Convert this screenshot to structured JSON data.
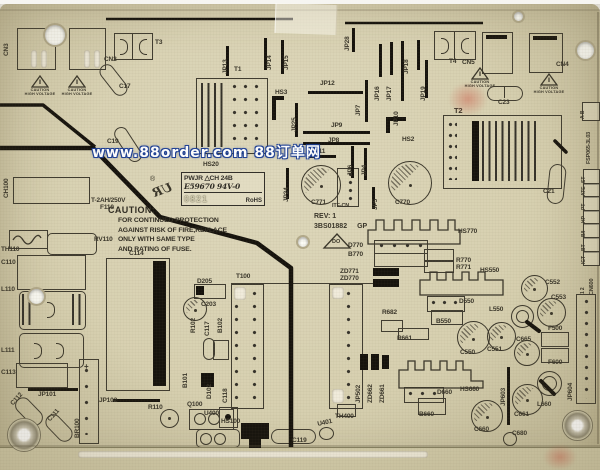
{
  "watermark": {
    "text": "www.88order.com 88订单网",
    "fill": "#ffffff",
    "outline": "#1d3e94"
  },
  "board": {
    "model": "FSP065-3L03",
    "base_color": "#d7d0b0",
    "silk_color": "#3a362a",
    "trace_color": "#16130d"
  },
  "ul_label": {
    "reg": "®",
    "ur": "UR",
    "line1": "PWJR  △CH 24B",
    "line2": "E59670  94V-0",
    "date": "0821",
    "rohs": "RoHS"
  },
  "caution": {
    "heading": "CAUTION:",
    "lines": [
      "FOR CONTINUED PROTECTION",
      "AGAINST RISK OF FIRE,REPLACE",
      "ONLY WITH SAME TYPE",
      "AND RATING OF FUSE."
    ]
  },
  "revision": {
    "rev": "REV: 1",
    "code": "3BS01882",
    "suffix": "GP",
    "triangle_mark": "DO"
  },
  "warning": {
    "line1": "CAUTION",
    "line2": "HIGH VOLTAGE"
  },
  "edge_strip": {
    "ab": "A B",
    "model": "FSP065-3L03",
    "tags": [
      "ST",
      "ATE",
      "PT",
      "HP",
      "B/I",
      "BT",
      "ICT"
    ],
    "connector": "CN600",
    "pins": "1 2"
  },
  "silkscreen_labels": [
    {
      "t": "CN2",
      "x": 104,
      "y": 53
    },
    {
      "t": "T3",
      "x": 155,
      "y": 36
    },
    {
      "t": "C17",
      "x": 119,
      "y": 80
    },
    {
      "t": "T1",
      "x": 234,
      "y": 63
    },
    {
      "t": "T4",
      "x": 449,
      "y": 55
    },
    {
      "t": "CN5",
      "x": 462,
      "y": 56
    },
    {
      "t": "CN4",
      "x": 556,
      "y": 58
    },
    {
      "t": "C23",
      "x": 498,
      "y": 96
    },
    {
      "t": "T2",
      "x": 454,
      "y": 103,
      "s": 7.5
    },
    {
      "t": "C21",
      "x": 543,
      "y": 185
    },
    {
      "t": "HS3",
      "x": 275,
      "y": 86
    },
    {
      "t": "JP12",
      "x": 320,
      "y": 77
    },
    {
      "t": "JP9",
      "x": 331,
      "y": 119
    },
    {
      "t": "JP8",
      "x": 328,
      "y": 134
    },
    {
      "t": "JP11",
      "x": 311,
      "y": 145
    },
    {
      "t": "HS2",
      "x": 402,
      "y": 133
    },
    {
      "t": "HS20",
      "x": 203,
      "y": 158
    },
    {
      "t": "C771",
      "x": 311,
      "y": 196
    },
    {
      "t": "ITF-CN",
      "x": 332,
      "y": 200,
      "s": 5.5
    },
    {
      "t": "C770",
      "x": 395,
      "y": 196
    },
    {
      "t": "C19",
      "x": 107,
      "y": 135
    },
    {
      "t": "T-2AH/250V",
      "x": 91,
      "y": 194
    },
    {
      "t": "F110",
      "x": 100,
      "y": 201
    },
    {
      "t": "RV110",
      "x": 94,
      "y": 233
    },
    {
      "t": "TH110",
      "x": 1,
      "y": 243
    },
    {
      "t": "C110",
      "x": 1,
      "y": 256
    },
    {
      "t": "L110",
      "x": 1,
      "y": 283
    },
    {
      "t": "L111",
      "x": 1,
      "y": 344
    },
    {
      "t": "C114",
      "x": 129,
      "y": 247
    },
    {
      "t": "C113",
      "x": 1,
      "y": 366
    },
    {
      "t": "JP101",
      "x": 38,
      "y": 388
    },
    {
      "t": "JP102",
      "x": 99,
      "y": 394
    },
    {
      "t": "R110",
      "x": 148,
      "y": 401
    },
    {
      "t": "Q100",
      "x": 187,
      "y": 398
    },
    {
      "t": "D205",
      "x": 197,
      "y": 275
    },
    {
      "t": "C203",
      "x": 201,
      "y": 298
    },
    {
      "t": "T100",
      "x": 236,
      "y": 270
    },
    {
      "t": "HS100",
      "x": 221,
      "y": 415
    },
    {
      "t": "U400",
      "x": 204,
      "y": 407
    },
    {
      "t": "C119",
      "x": 292,
      "y": 434
    },
    {
      "t": "TH400",
      "x": 335,
      "y": 410
    },
    {
      "t": "ZD771",
      "x": 340,
      "y": 265
    },
    {
      "t": "ZD770",
      "x": 340,
      "y": 272
    },
    {
      "t": "D770",
      "x": 348,
      "y": 239
    },
    {
      "t": "B770",
      "x": 348,
      "y": 248
    },
    {
      "t": "R770",
      "x": 456,
      "y": 254
    },
    {
      "t": "R771",
      "x": 456,
      "y": 261
    },
    {
      "t": "HS770",
      "x": 458,
      "y": 225
    },
    {
      "t": "R682",
      "x": 382,
      "y": 306
    },
    {
      "t": "R661",
      "x": 397,
      "y": 332
    },
    {
      "t": "HS550",
      "x": 480,
      "y": 264
    },
    {
      "t": "D550",
      "x": 459,
      "y": 295
    },
    {
      "t": "B550",
      "x": 436,
      "y": 315
    },
    {
      "t": "C550",
      "x": 460,
      "y": 346
    },
    {
      "t": "C551",
      "x": 487,
      "y": 343
    },
    {
      "t": "L550",
      "x": 489,
      "y": 303
    },
    {
      "t": "C552",
      "x": 545,
      "y": 276
    },
    {
      "t": "C553",
      "x": 551,
      "y": 291
    },
    {
      "t": "C665",
      "x": 516,
      "y": 333
    },
    {
      "t": "F500",
      "x": 548,
      "y": 322
    },
    {
      "t": "F600",
      "x": 548,
      "y": 356
    },
    {
      "t": "HS660",
      "x": 460,
      "y": 383
    },
    {
      "t": "D660",
      "x": 437,
      "y": 386
    },
    {
      "t": "B660",
      "x": 419,
      "y": 408
    },
    {
      "t": "C660",
      "x": 474,
      "y": 423
    },
    {
      "t": "C661",
      "x": 514,
      "y": 408
    },
    {
      "t": "L660",
      "x": 537,
      "y": 398
    },
    {
      "t": "C680",
      "x": 512,
      "y": 427
    },
    {
      "t": "+",
      "x": 84,
      "y": 359,
      "s": 8
    },
    {
      "t": "-",
      "x": 85,
      "y": 426,
      "s": 9
    },
    {
      "t": "CN3",
      "x": 4,
      "y": 52,
      "r": -90
    },
    {
      "t": "JP13",
      "x": 223,
      "y": 70,
      "r": -90
    },
    {
      "t": "JP14",
      "x": 267,
      "y": 66,
      "r": -90
    },
    {
      "t": "JP15",
      "x": 284,
      "y": 66,
      "r": -90
    },
    {
      "t": "JP28",
      "x": 345,
      "y": 47,
      "r": -90
    },
    {
      "t": "JP16",
      "x": 375,
      "y": 97,
      "r": -90
    },
    {
      "t": "JP17",
      "x": 387,
      "y": 97,
      "r": -90
    },
    {
      "t": "JP18",
      "x": 404,
      "y": 70,
      "r": -90
    },
    {
      "t": "JP19",
      "x": 421,
      "y": 97,
      "r": -90
    },
    {
      "t": "JP10",
      "x": 394,
      "y": 122,
      "r": -90
    },
    {
      "t": "JP7",
      "x": 356,
      "y": 112,
      "r": -90
    },
    {
      "t": "JP25",
      "x": 292,
      "y": 128,
      "r": -90
    },
    {
      "t": "JP24",
      "x": 284,
      "y": 198,
      "r": -90
    },
    {
      "t": "JP6",
      "x": 348,
      "y": 172,
      "r": -90
    },
    {
      "t": "JP4",
      "x": 362,
      "y": 172,
      "r": -90
    },
    {
      "t": "JP5",
      "x": 373,
      "y": 206,
      "r": -90
    },
    {
      "t": "CH100",
      "x": 4,
      "y": 194,
      "r": -90
    },
    {
      "t": "BR100",
      "x": 75,
      "y": 434,
      "r": -90
    },
    {
      "t": "B101",
      "x": 183,
      "y": 384,
      "r": -90
    },
    {
      "t": "D102",
      "x": 207,
      "y": 395,
      "r": -90
    },
    {
      "t": "C118",
      "x": 223,
      "y": 399,
      "r": -90
    },
    {
      "t": "R102",
      "x": 191,
      "y": 329,
      "r": -90
    },
    {
      "t": "C117",
      "x": 205,
      "y": 332,
      "r": -90
    },
    {
      "t": "B102",
      "x": 218,
      "y": 329,
      "r": -90
    },
    {
      "t": "JP502",
      "x": 356,
      "y": 399,
      "r": -90
    },
    {
      "t": "ZD662",
      "x": 368,
      "y": 399,
      "r": -90
    },
    {
      "t": "ZD661",
      "x": 380,
      "y": 399,
      "r": -90
    },
    {
      "t": "JP603",
      "x": 501,
      "y": 402,
      "r": -90
    },
    {
      "t": "JP604",
      "x": 568,
      "y": 397,
      "r": -90
    },
    {
      "t": "CN600",
      "x": 590,
      "y": 291,
      "r": -90,
      "s": 5.5
    },
    {
      "t": "1 2",
      "x": 581,
      "y": 290,
      "r": -90,
      "s": 5
    },
    {
      "t": "C112",
      "x": 10,
      "y": 399,
      "r": -48
    },
    {
      "t": "C111",
      "x": 47,
      "y": 415,
      "r": -48
    },
    {
      "t": "U401",
      "x": 317,
      "y": 418,
      "r": -12
    }
  ]
}
